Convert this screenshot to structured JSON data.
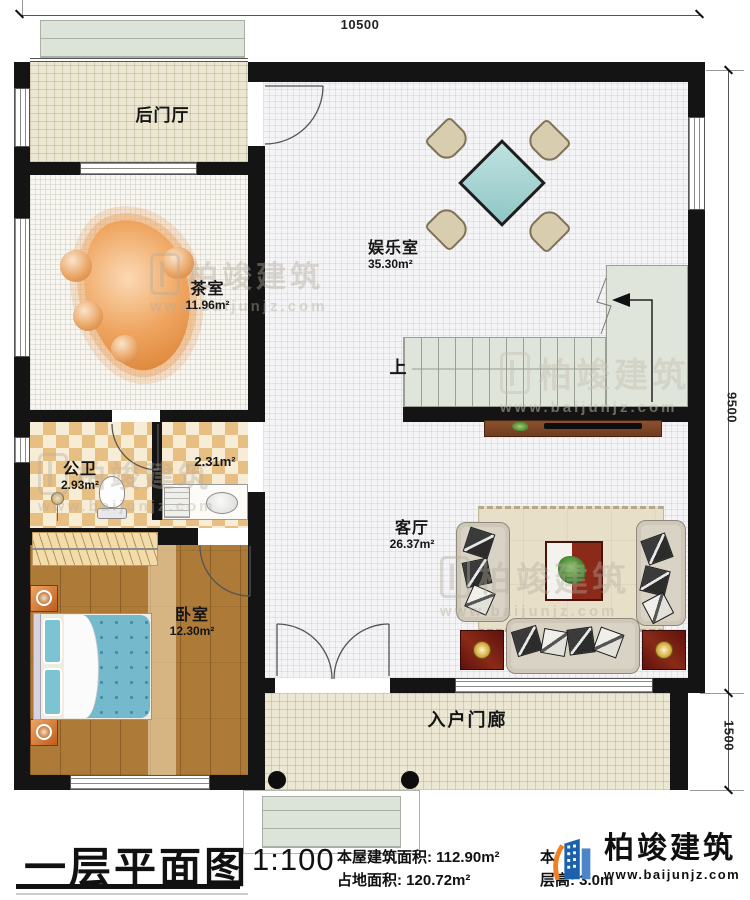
{
  "dimensions": {
    "top": "10500",
    "right_upper": "9500",
    "right_lower": "1500"
  },
  "rooms": {
    "back_hall": {
      "name": "后门厅"
    },
    "tea_room": {
      "name": "茶室",
      "area": "11.96m²"
    },
    "entertainment": {
      "name": "娱乐室",
      "area": "35.30m²"
    },
    "bathroom": {
      "name": "公卫",
      "area": "2.93m²"
    },
    "bath_lobby": {
      "area": "2.31m²"
    },
    "bedroom": {
      "name": "卧室",
      "area": "12.30m²"
    },
    "living_room": {
      "name": "客厅",
      "area": "26.37m²"
    },
    "porch": {
      "name": "入户门廊"
    },
    "stairs": {
      "up_label": "上"
    }
  },
  "titleblock": {
    "title": "一层平面图",
    "scale": "1:100",
    "area_line1": "本屋建筑面积: 112.90m²",
    "area_line2": "占地面积: 120.72m²",
    "area_line3_fragment": "本",
    "floor_height": "层高: 3.0m"
  },
  "brand": {
    "name": "柏竣建筑",
    "url": "www.baijunjz.com"
  },
  "watermark": {
    "name": "柏竣建筑",
    "url": "www.baijunjz.com"
  },
  "colors": {
    "wall": "#141414",
    "wood_floor": "#ad7a38",
    "checker": "#e8bf82",
    "tile": "#ebe7d2",
    "stair": "#e0e5dc",
    "table_teal": "#a9d6d4",
    "rug": "#e8dfc9",
    "brand_blue": "#1b61ae",
    "brand_orange": "#f08020"
  }
}
